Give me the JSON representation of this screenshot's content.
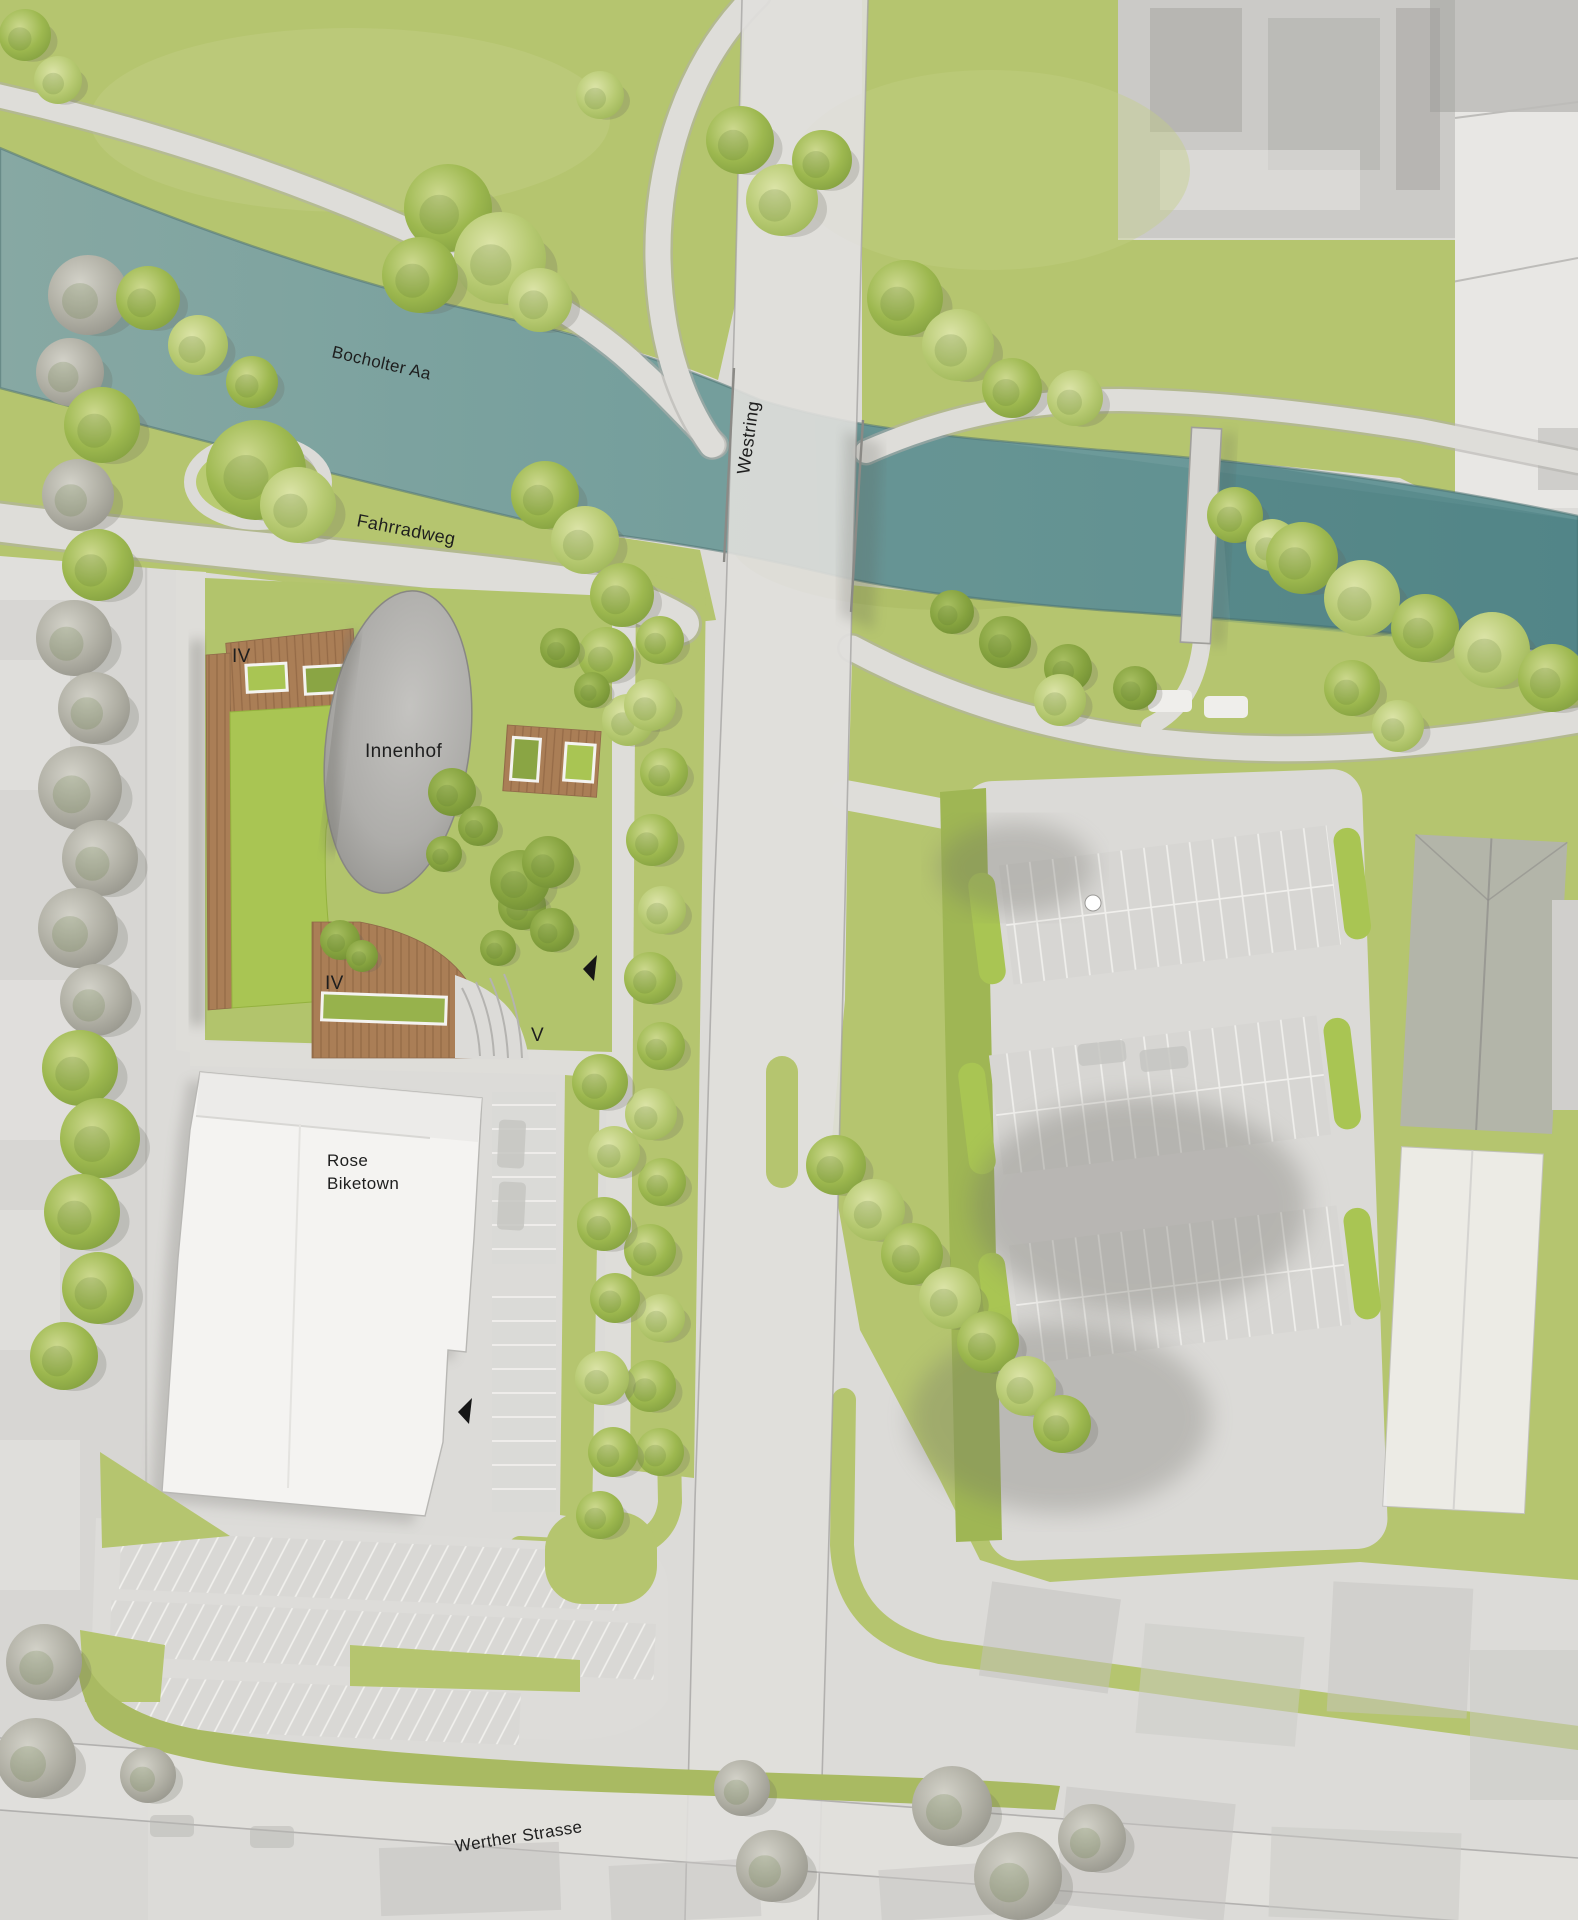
{
  "labels": {
    "river": "Bocholter Aa",
    "main_road": "Westring",
    "bike_path": "Fahrradweg",
    "courtyard": "Innenhof",
    "store_line1": "Rose",
    "store_line2": "Biketown",
    "south_street": "Werther Strasse"
  },
  "floors": {
    "north_wing": "IV",
    "south_wing": "IV",
    "corner_tower": "V"
  },
  "icons": {
    "entrance_arrow": "solid black left-pointing triangle"
  },
  "colors": {
    "water": "#7ba4a1",
    "water_deep": "#54858a",
    "meadow": "#b5c56f",
    "lawn_roof": "#a9c553",
    "shrub": "#8aa544",
    "wood_deck": "#aa7e56",
    "road": "#e0dfdc",
    "path": "#deddd9",
    "courtyard": "#a7a6a3",
    "building": "#f4f3f1",
    "context": "#c9c8c5",
    "label": "#1e1e1e"
  }
}
